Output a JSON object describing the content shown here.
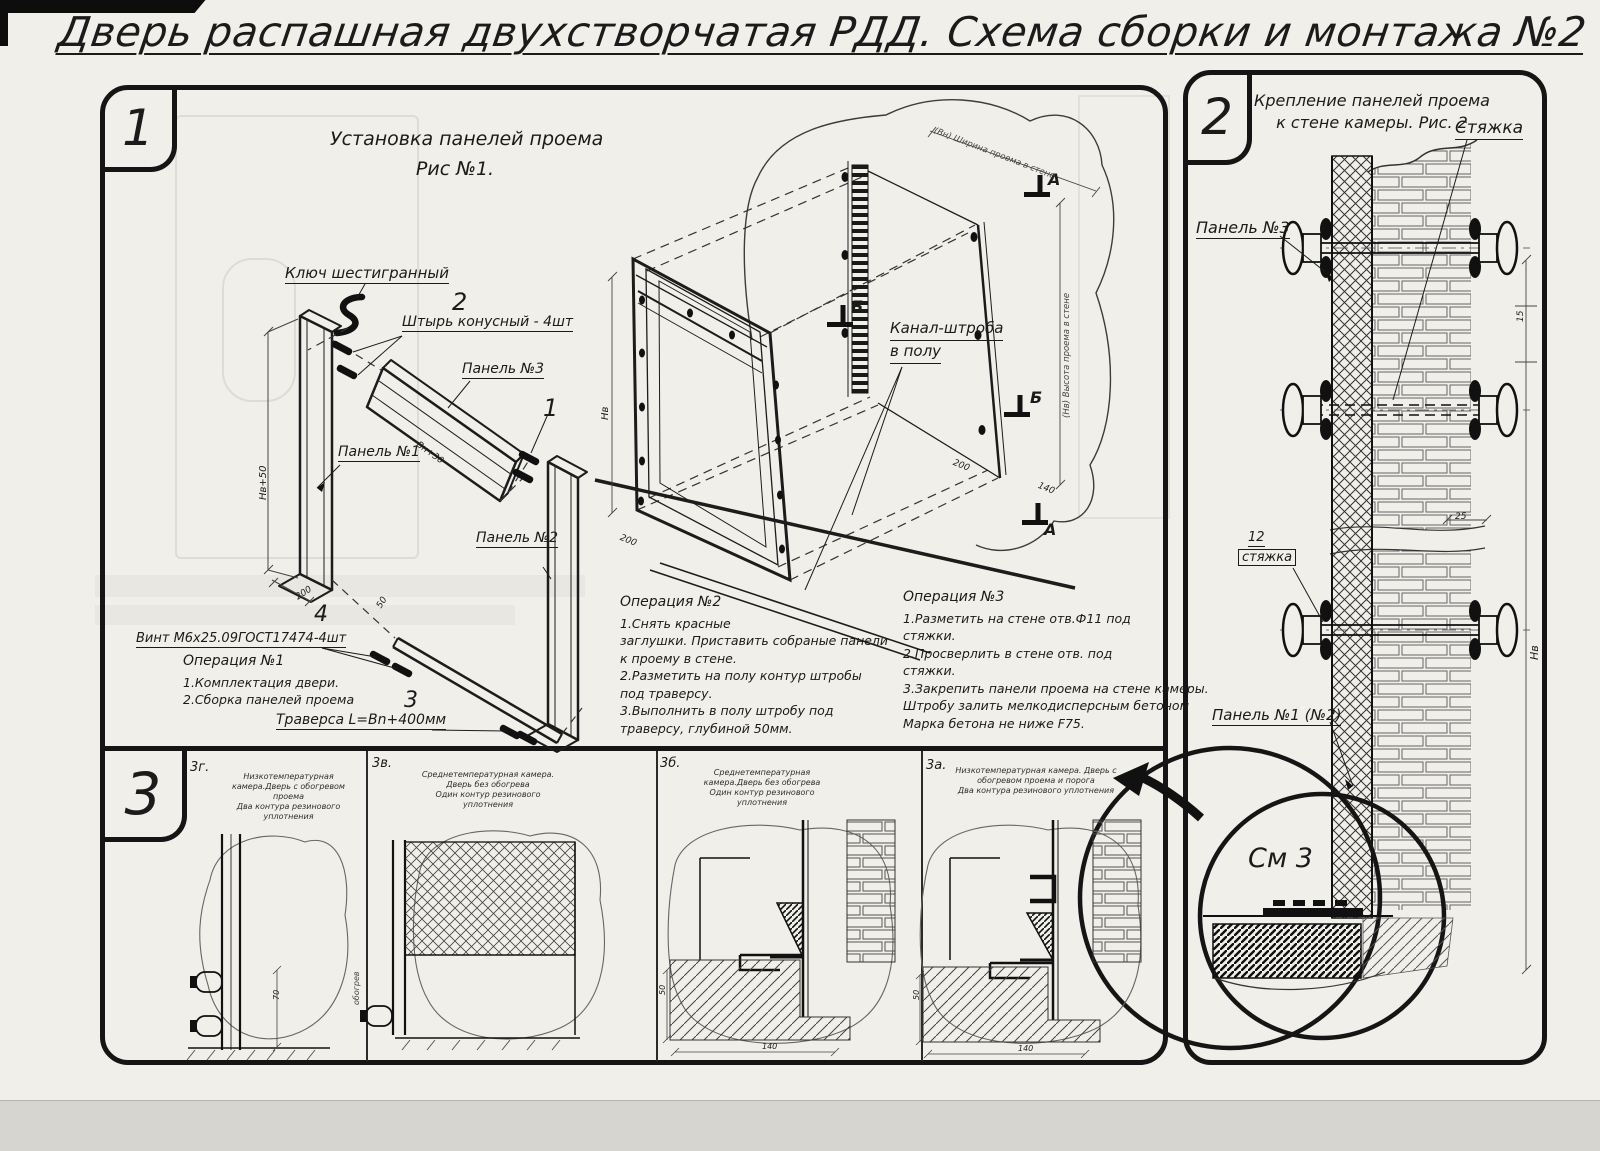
{
  "title": "Дверь распашная двухстворчатая РДД.  Схема сборки и монтажа №2",
  "s1": {
    "badge": "1",
    "heading1": "Установка панелей проема",
    "heading2": "Рис №1.",
    "hex_key": "Ключ шестигранный",
    "pin_no": "2",
    "pin": "Штырь конусный - 4шт",
    "panel3": "Панель №3",
    "panel3_no": "1",
    "panel1": "Панель №1",
    "panel2": "Панель №2",
    "screw_no": "4",
    "screw": "Винт М6х25.09ГОСТ17474-4шт",
    "traverse_no": "3",
    "traverse": "Траверса  L=Bn+400мм",
    "channel1": "Канал-штроба",
    "channel2": "в полу",
    "marker_a": "А",
    "marker_b": "Б",
    "dim_h_panel": "Нв+50",
    "dim_w_panel": "Вн+30",
    "dim_200a": "200",
    "dim_200b": "200",
    "dim_200c": "200",
    "dim_50": "50",
    "dim_140": "140",
    "dim_hv": "Нв",
    "dim_wall_w": "(Вн) Ширина проема в стене",
    "dim_wall_h": "(Нв) Высота проема в стене",
    "op1_title": "Операция №1",
    "op1_1": "1.Комплектация двери.",
    "op1_2": "2.Сборка панелей проема",
    "op2_title": "Операция №2",
    "op2_1": "1.Снять красные",
    "op2_2": "заглушки. Приставить собраные панели",
    "op2_3": "к проему в стене.",
    "op2_4": "2.Разметить на полу контур штробы",
    "op2_5": "под траверсу.",
    "op2_6": "3.Выполнить в полу штробу под",
    "op2_7": "траверсу, глубиной 50мм.",
    "op3_title": "Операция №3",
    "op3_1": "1.Разметить на стене отв.Ф11 под",
    "op3_2": "стяжки.",
    "op3_3": "2.Просверлить в стене отв.   под",
    "op3_4": "стяжки.",
    "op3_5": "3.Закрепить панели проема на стене камеры.",
    "op3_6": "Штробу залить мелкодисперсным бетоном",
    "op3_7": "Марка бетона не ниже   F75."
  },
  "s2": {
    "badge": "2",
    "heading1": "Крепление панелей проема",
    "heading2": "к стене камеры. Рис. 2",
    "tie": "Стяжка",
    "panel3": "Панель №3",
    "item_no": "12",
    "item": "стяжка",
    "panel12": "Панель №1 (№2)",
    "see": "См 3",
    "dim15": "15",
    "dim25": "25",
    "dimh": "Нв"
  },
  "s3": {
    "badge": "3",
    "c1_id": "3г.",
    "c1_l1": "Низкотемпературная камера.Дверь с обогревом проема",
    "c1_l2": "Два контура резинового уплотнения",
    "c2_id": "3в.",
    "c2_l1": "Среднетемпературная камера. Дверь без обогрева",
    "c2_l2": "Один контур резинового уплотнения",
    "c3_id": "3б.",
    "c3_l1": "Среднетемпературная камера.Дверь без обогрева",
    "c3_l2": "Один контур резинового уплотнения",
    "c4_id": "3а.",
    "c4_l1": "Низкотемпературная камера. Дверь с обогревом проема и порога",
    "c4_l2": "Два контура резинового уплотнения",
    "d70": "70",
    "note": "обогрев",
    "d50a": "50",
    "d140a": "140",
    "d50b": "50",
    "d140b": "140"
  }
}
